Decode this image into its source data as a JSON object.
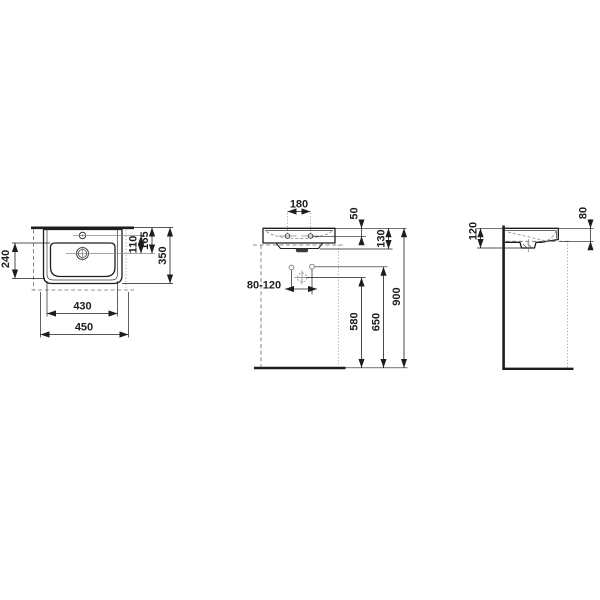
{
  "colors": {
    "line": "#1d1d1b",
    "hidden": "#8a8a8a",
    "dashed_outline": "#6f6f6f",
    "background": "#ffffff"
  },
  "top_view": {
    "dim_bowl_depth": "240",
    "dim_tap_to_drain": "110",
    "dim_back_to_drain": "165",
    "dim_depth": "350",
    "dim_inner_width": "430",
    "dim_width": "450"
  },
  "front_view": {
    "dim_hole_spacing": "180",
    "dim_top_to_holes": "50",
    "dim_body_height": "130",
    "dim_supply_offset_range": "80-120",
    "dim_floor_to_drain": "580",
    "dim_floor_to_supply": "650",
    "dim_floor_to_rim": "900"
  },
  "side_view": {
    "dim_back_height": "120",
    "dim_front_height": "80"
  }
}
